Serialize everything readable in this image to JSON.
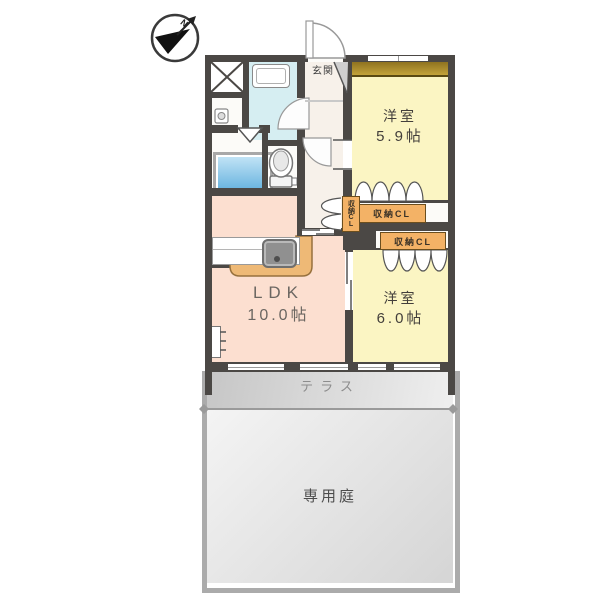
{
  "plan": {
    "compass": {
      "label": "N"
    },
    "entrance": {
      "label": "玄関"
    },
    "rooms": {
      "bedroom1": {
        "name": "洋室",
        "size": "5.9帖"
      },
      "bedroom2": {
        "name": "洋室",
        "size": "6.0帖"
      },
      "ldk": {
        "name": "LDK",
        "size": "10.0帖"
      }
    },
    "closets": {
      "closet_a": {
        "label": "収納CL"
      },
      "closet_b": {
        "label": "収納CL"
      },
      "closet_hall": {
        "label": "収納CL"
      }
    },
    "outdoor": {
      "terrace": {
        "label": "テラス"
      },
      "garden": {
        "label": "専用庭"
      }
    }
  },
  "colors": {
    "wall": "#4b4845",
    "room-yellow": "#fbf5c3",
    "ldk-pink": "#fcdfd0",
    "corridor": "#f7f1ea",
    "wet-blue": "#d6eef2",
    "orange": "#f3b266",
    "tan": "#eeb976",
    "window-brown": "#8f7320",
    "terrace-gray": "#cfcfcf",
    "garden-gray": "#e9e9e9",
    "dark-text": "#433f3b",
    "gray-text": "#8d8d8d"
  }
}
